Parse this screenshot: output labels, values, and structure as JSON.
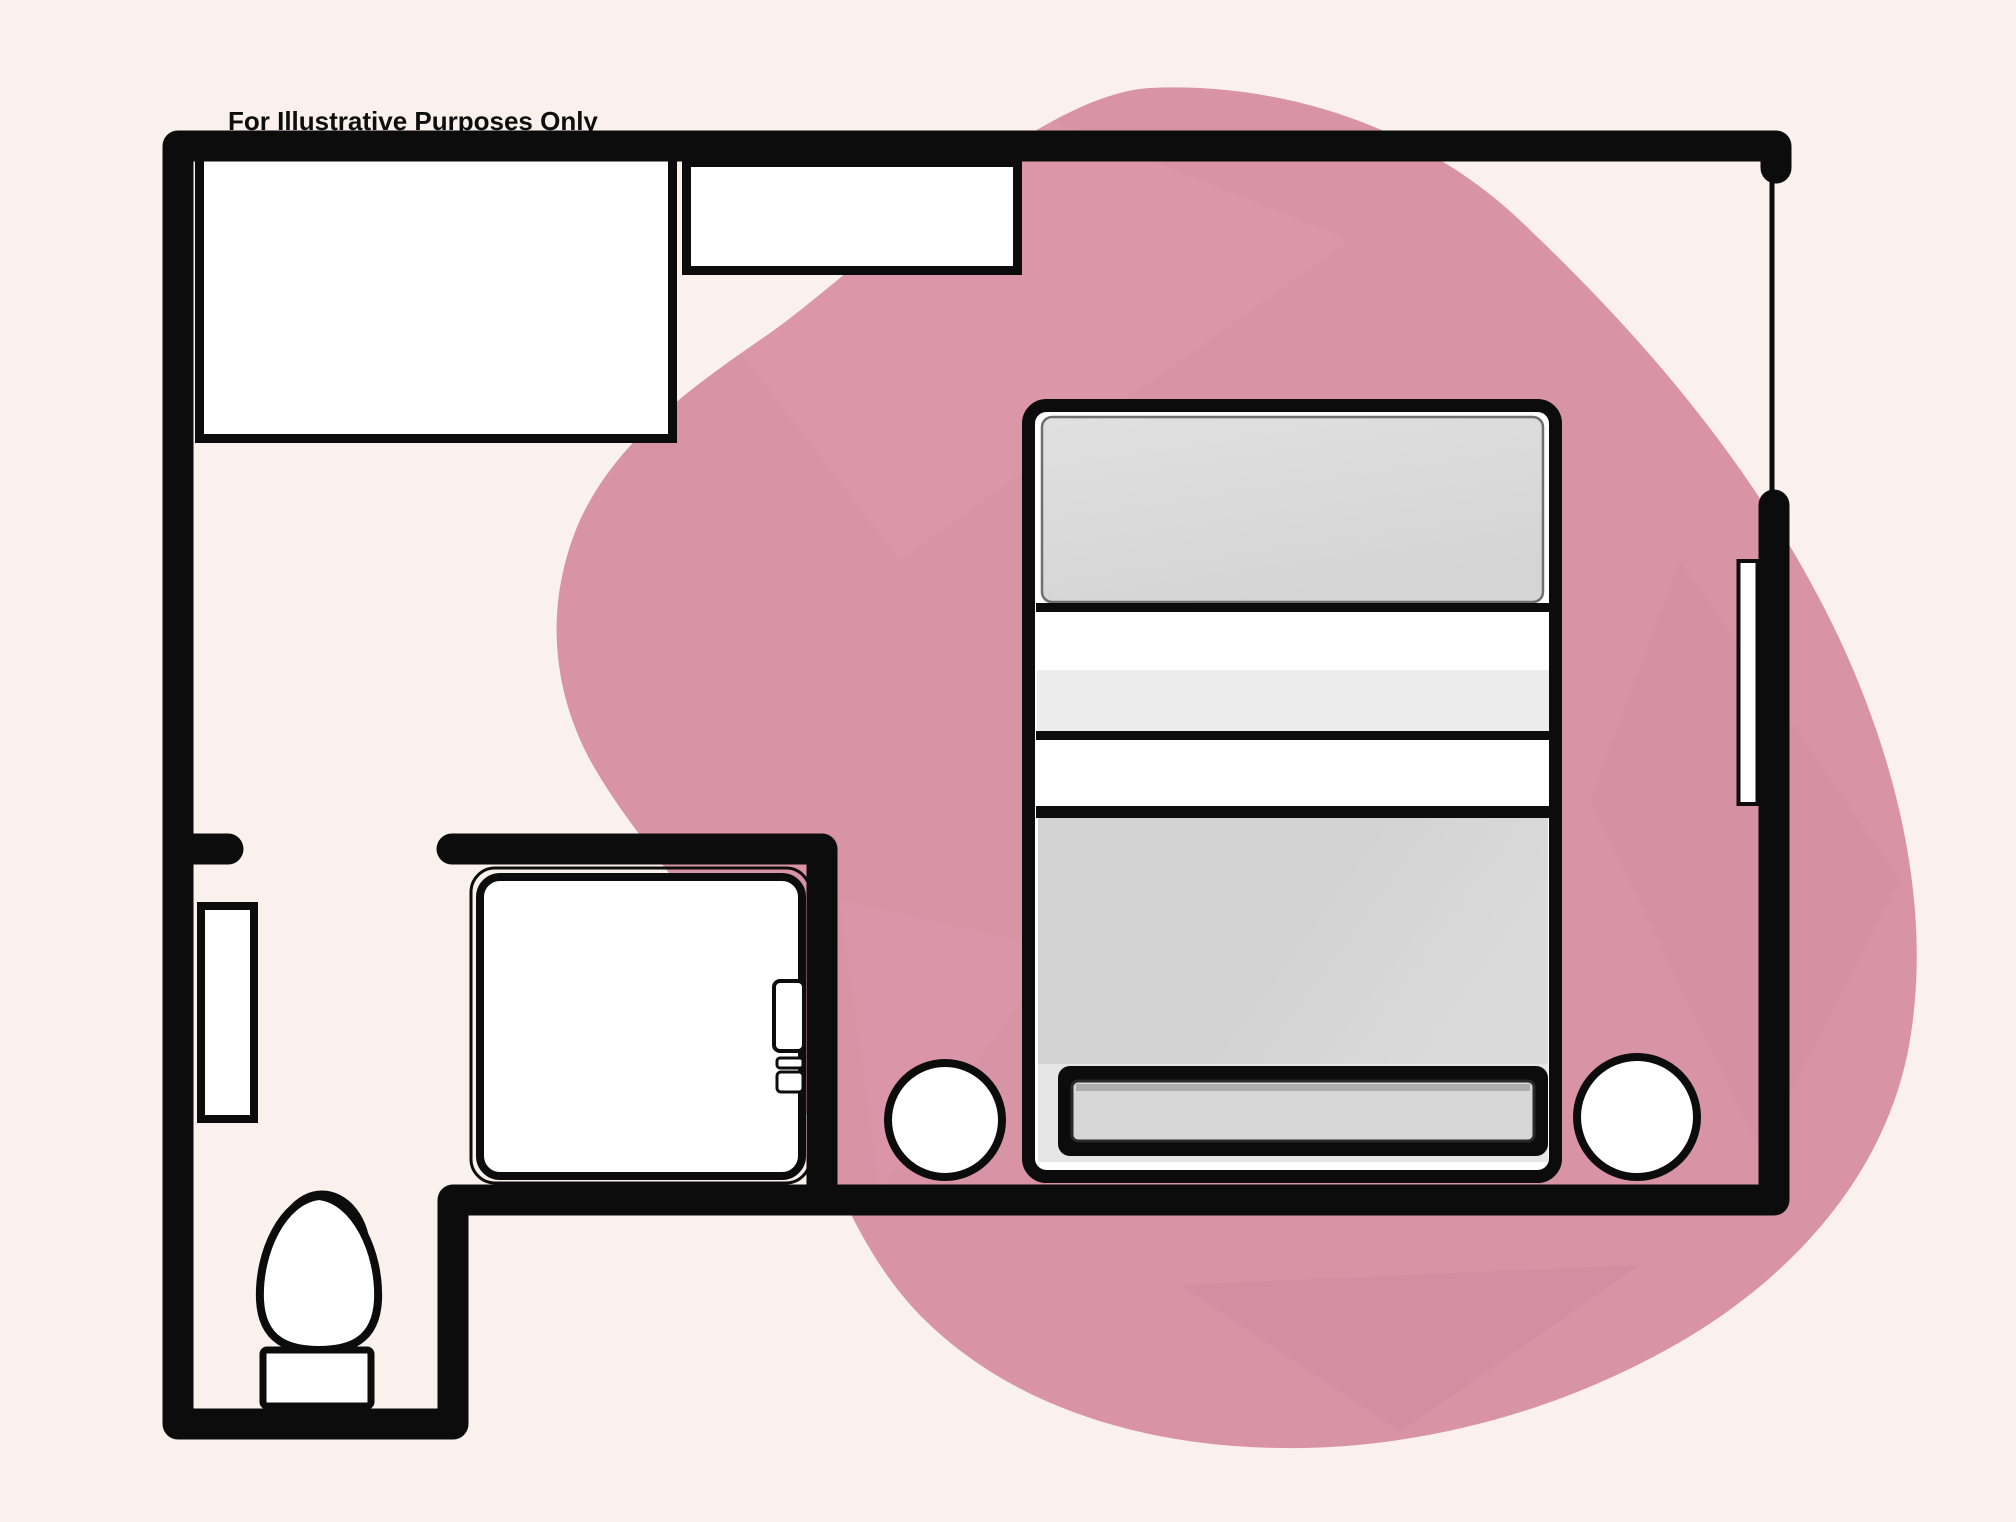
{
  "caption": {
    "text": "For Illustrative Purposes Only"
  },
  "colors": {
    "background": "#faf1ed",
    "ink": "#0d0d0d",
    "wall_black": "#0c0c0c",
    "blob_pink": "#d893a5",
    "blob_pink_light": "#df9dae",
    "blob_pink_dark": "#cd879c",
    "furniture_white": "#ffffff",
    "pillow_gray": "#d5d5d5",
    "pillow_gray_light": "#e0e0e0",
    "band_pale_gray": "#ececec",
    "bed_body_gray": "#d3d3d3",
    "bed_base_gray": "#e6e6e6",
    "footboard_bar_gray": "#d7d7d7",
    "soft_outline_gray": "#6f6f6f"
  },
  "diagram": {
    "type": "floor-plan",
    "elements": [
      {
        "id": "accent-blob",
        "kind": "decorative-shape"
      },
      {
        "id": "closet",
        "kind": "fixture"
      },
      {
        "id": "dresser",
        "kind": "fixture"
      },
      {
        "id": "bed",
        "kind": "furniture"
      },
      {
        "id": "pillow",
        "kind": "furniture-part"
      },
      {
        "id": "footboard-bench",
        "kind": "furniture-part"
      },
      {
        "id": "nightstand-left",
        "kind": "furniture"
      },
      {
        "id": "nightstand-right",
        "kind": "furniture"
      },
      {
        "id": "shower",
        "kind": "fixture"
      },
      {
        "id": "shower-handle",
        "kind": "fixture-part"
      },
      {
        "id": "toilet",
        "kind": "fixture"
      },
      {
        "id": "door-panel-left",
        "kind": "opening"
      },
      {
        "id": "door-opening-right",
        "kind": "opening"
      },
      {
        "id": "window-right",
        "kind": "opening"
      },
      {
        "id": "walls",
        "kind": "structure"
      }
    ]
  }
}
